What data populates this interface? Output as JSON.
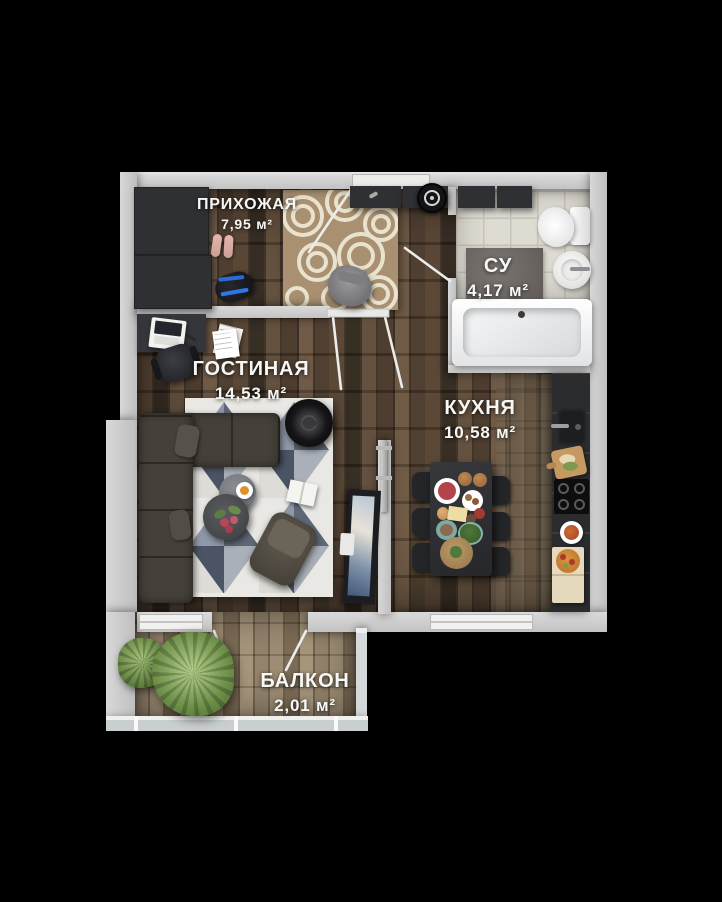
{
  "rooms": {
    "hallway": {
      "name": "ПРИХОЖАЯ",
      "area": "7,95 м²"
    },
    "bathroom": {
      "name": "СУ",
      "area": "4,17 м²"
    },
    "living": {
      "name": "ГОСТИНАЯ",
      "area": "14,53 м²"
    },
    "kitchen": {
      "name": "КУХНЯ",
      "area": "10,58 м²"
    },
    "balcony": {
      "name": "БАЛКОН",
      "area": "2,01 м²"
    }
  },
  "palette": {
    "background": "#000000",
    "walls": "#cfcfcf",
    "wood_floor": "#4a3a2b",
    "balcony_floor": "#85755d",
    "tile_floor": "#dedbd2",
    "label_text": "#f7f7f5",
    "hall_rug": "#a89070",
    "geo_rug_slate": "#9099a9"
  }
}
